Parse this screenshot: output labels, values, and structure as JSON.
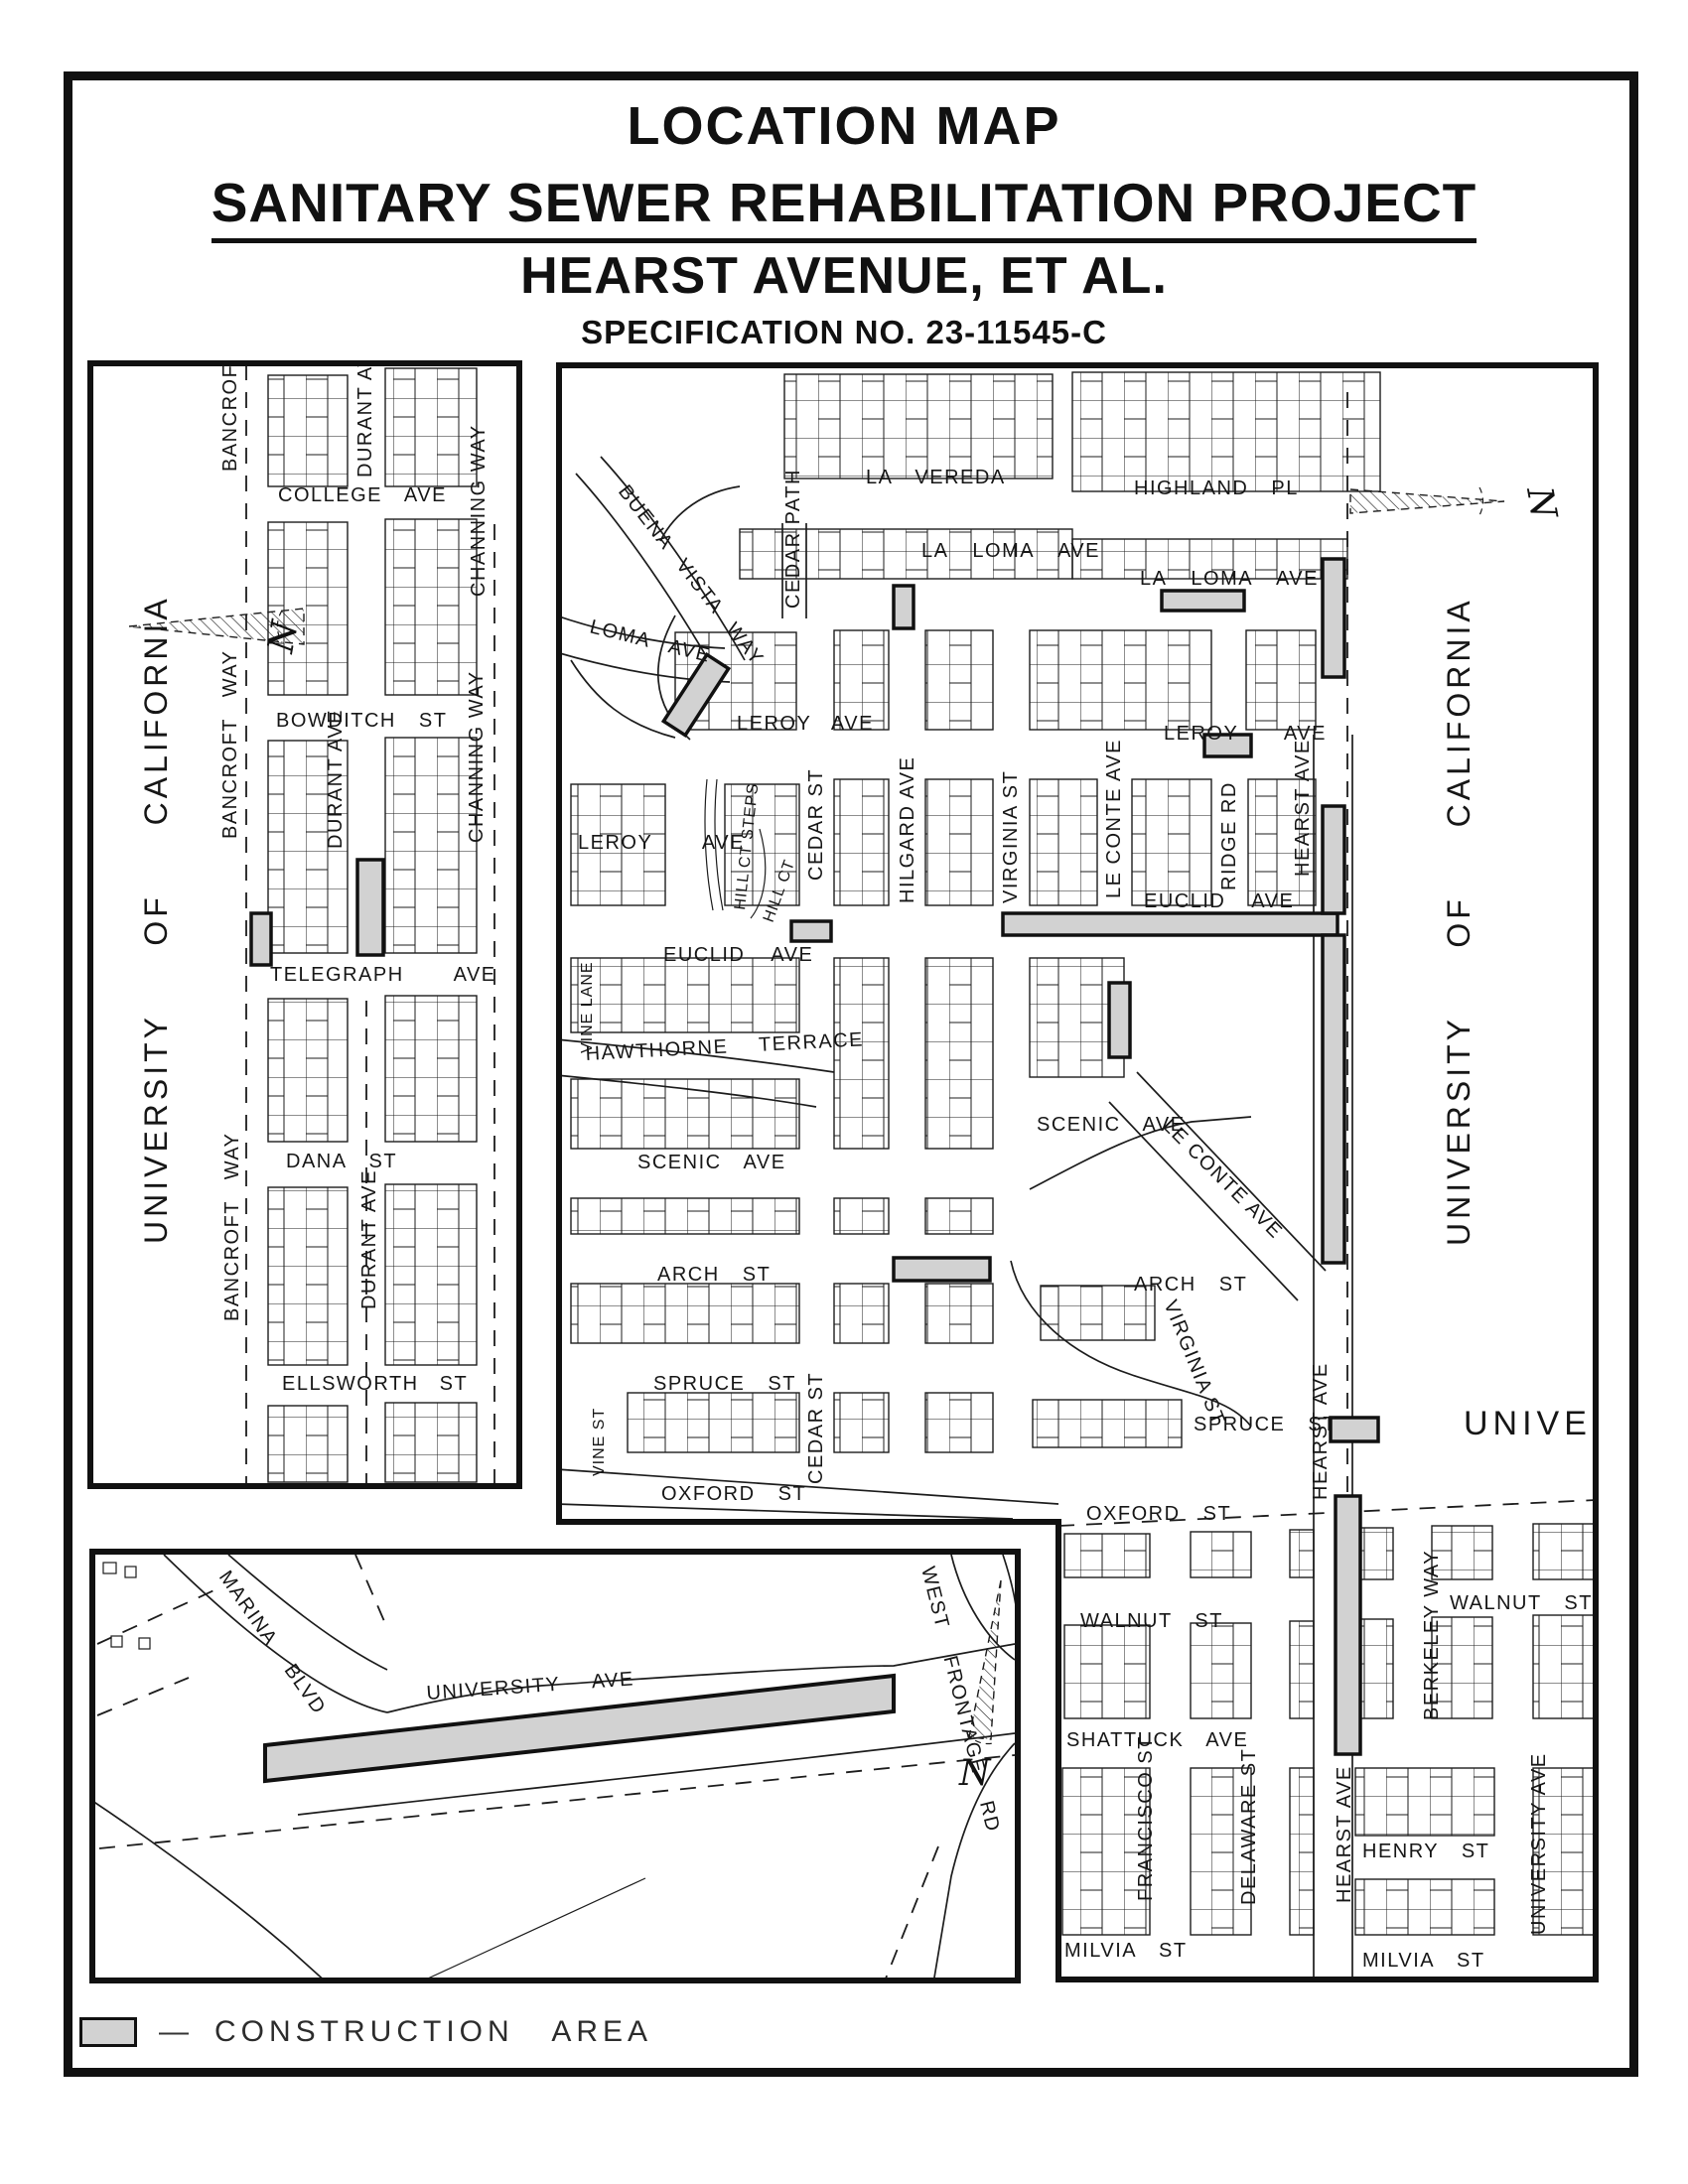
{
  "title": {
    "line1": "LOCATION MAP",
    "line2": "SANITARY SEWER REHABILITATION PROJECT",
    "line3": "HEARST AVENUE, ET AL.",
    "line4": "SPECIFICATION NO. 23-11545-C"
  },
  "legend": {
    "dash": "—",
    "label": "CONSTRUCTION AREA"
  },
  "campus_label": "UNIVERSITY OF CALIFORNIA",
  "north_label": "N",
  "colors": {
    "construction": "#d2d2d2",
    "line": "#1c1c1c",
    "background": "#ffffff"
  },
  "streets": {
    "bancroft": "BANCROFT WAY",
    "college": "COLLEGE AVE",
    "durant": "DURANT AVE",
    "channing": "CHANNING WAY",
    "bowditch": "BOWDITCH ST",
    "telegraph": "TELEGRAPH AVE",
    "dana": "DANA ST",
    "ellsworth": "ELLSWORTH ST",
    "la_vereda": "LA VEREDA",
    "highland": "HIGHLAND PL",
    "la_loma": "LA LOMA AVE",
    "loma_w": "LOMA AVE",
    "buena_vista": "BUENA VISTA WAY",
    "cedar_path": "CEDAR PATH",
    "leroy": "LEROY AVE",
    "hill_ct_steps": "HILL CT STEPS",
    "hill_ct": "HILL CT",
    "cedar": "CEDAR ST",
    "hilgard": "HILGARD AVE",
    "virginia": "VIRGINIA ST",
    "le_conte": "LE CONTE AVE",
    "ridge": "RIDGE RD",
    "hearst": "HEARST AVE",
    "euclid": "EUCLID AVE",
    "vine_lane": "VINE LANE",
    "hawthorne": "HAWTHORNE TERRACE",
    "scenic": "SCENIC AVE",
    "arch": "ARCH ST",
    "spruce": "SPRUCE ST",
    "vine": "VINE ST",
    "oxford": "OXFORD ST",
    "walnut": "WALNUT ST",
    "berkeley": "BERKELEY WAY",
    "shattuck": "SHATTUCK AVE",
    "francisco": "FRANCISCO ST",
    "delaware": "DELAWARE ST",
    "henry": "HENRY ST",
    "milvia": "MILVIA ST",
    "university_ave": "UNIVERSITY AVE",
    "universi_clip": "UNIVERSI",
    "marina": "MARINA BLVD",
    "west_frontage": "WEST FRONTAGE RD"
  }
}
